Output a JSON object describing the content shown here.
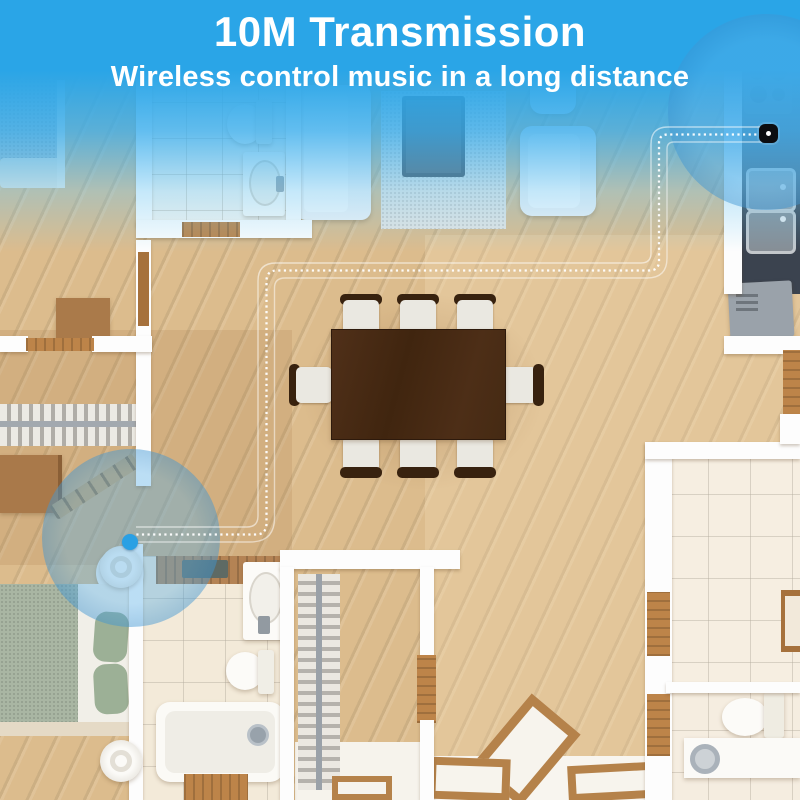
{
  "header": {
    "title": "10M Transmission",
    "subtitle": "Wireless control music in a long distance"
  },
  "theme": {
    "banner_blue": "#2aa5e7",
    "highlight_circle_blue": "rgba(62,155,219,0.5)",
    "transmission_path_color": "#ffffff",
    "endpoint_dot_blue": "#2aa0e4",
    "wood_floor": "#dcbc8d",
    "kitchen_counter_dark": "#3b434f",
    "dining_table_brown": "#4a2c17"
  },
  "annotations": {
    "source_device": "music-receiver-on-kitchen-counter",
    "target_device": "wireless-speaker-near-door",
    "path_style": "dotted-line"
  }
}
